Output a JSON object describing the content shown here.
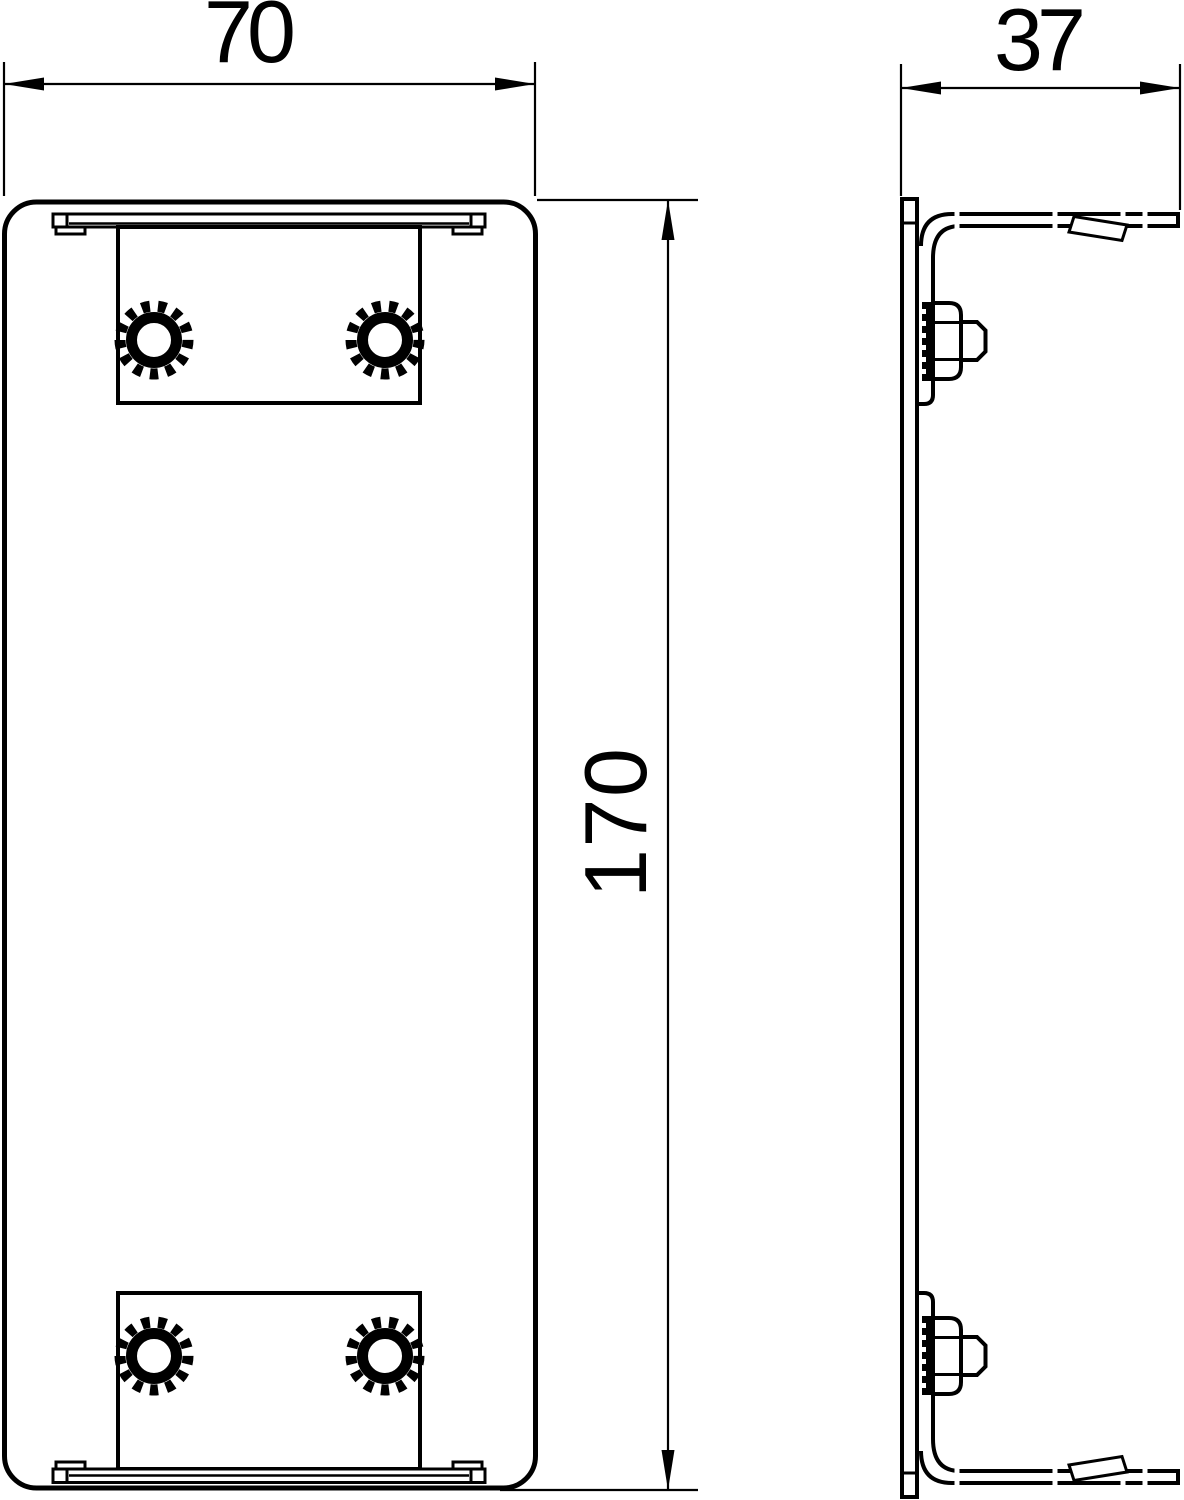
{
  "drawing": {
    "type": "technical-orthographic-drawing",
    "background_color": "#ffffff",
    "line_color": "#000000",
    "views": {
      "front": "end-piece front elevation with two mounting plates and four serrated fasteners",
      "side": "end-piece side profile with flanges, latch clips and two hex bolts"
    },
    "dimensions": {
      "front_width": {
        "label": "70"
      },
      "side_depth": {
        "label": "37"
      },
      "front_height": {
        "label": "170"
      }
    }
  }
}
